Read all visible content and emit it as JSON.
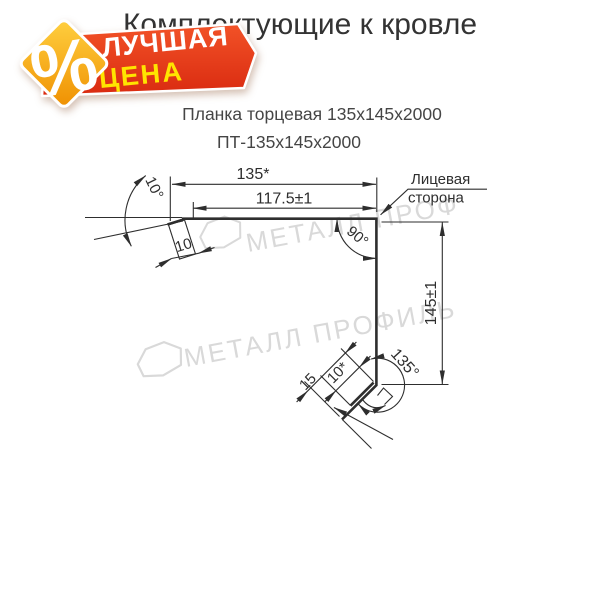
{
  "header": {
    "title": "Комплектующие к кровле"
  },
  "product": {
    "name": "Планка торцевая 135х145х2000",
    "code": "ПТ-135х145х2000"
  },
  "badge": {
    "percent_symbol": "%",
    "top_label": "ЛУЧШАЯ",
    "bottom_label": "ЦЕНА",
    "ribbon_color_top": "#f25227",
    "ribbon_color_bottom": "#d92a10",
    "diamond_color_top": "#ffd040",
    "diamond_color_bottom": "#ef8f00",
    "bottom_label_color": "#ffe400"
  },
  "drawing": {
    "line_color": "#2e2e2e",
    "dims": {
      "total_width": "135*",
      "face_width": "117.5±1",
      "left_hem_angle": "10°",
      "left_hem_length": "10",
      "corner_angle": "90°",
      "height": "145±1",
      "bottom_angle": "135°",
      "bottom_hem_length": "10*",
      "bottom_lip_length": "15"
    },
    "face_side_label": {
      "line1": "Лицевая",
      "line2": "сторона"
    }
  },
  "watermarks": {
    "color": "#d9d9d9",
    "top_text": "МЕТАЛЛ ПРОФ",
    "middle_text": "МЕТАЛЛ ПРОФИЛЬ"
  }
}
